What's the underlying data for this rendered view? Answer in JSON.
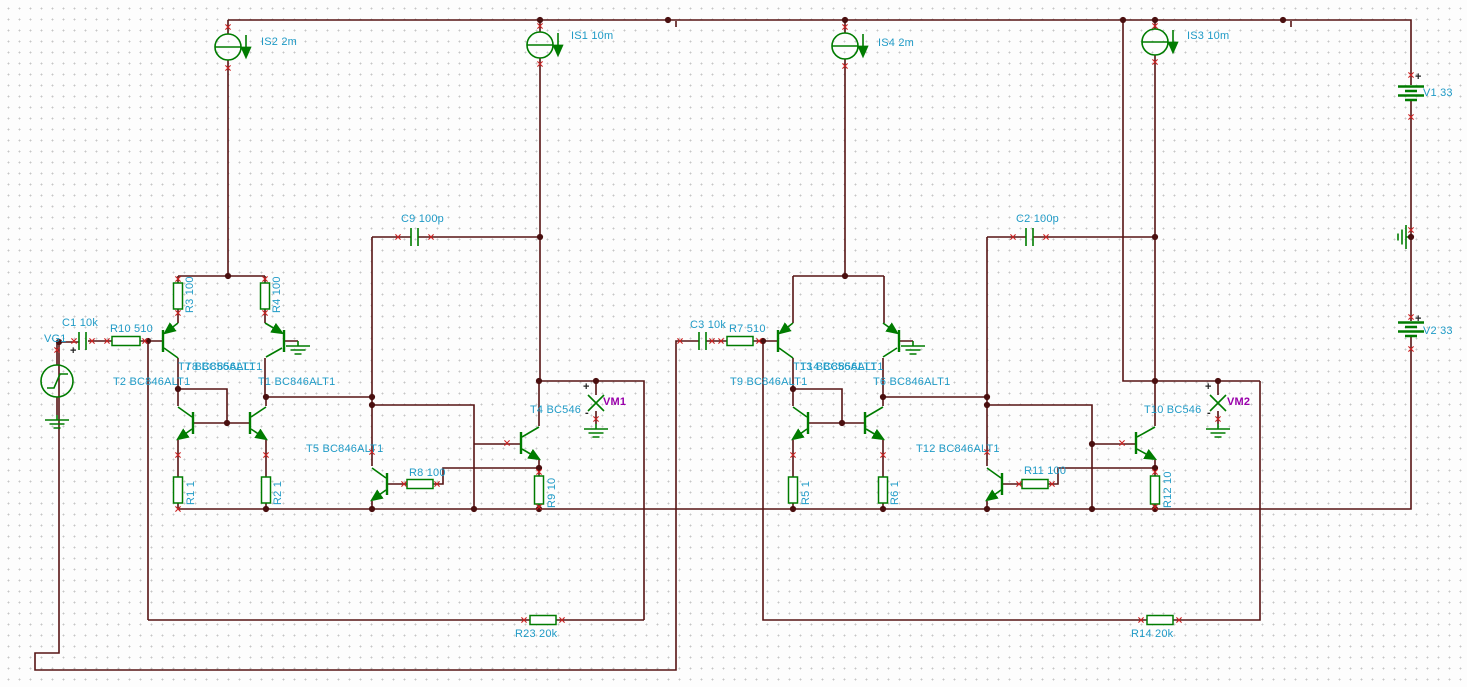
{
  "app": {
    "view": "circuit-schematic-canvas"
  },
  "colors": {
    "wire": "#571414",
    "component": "#007c00",
    "label": "#1f9ac6",
    "meter_label": "#9900aa",
    "pin_mark": "#cc2222",
    "junction": "#4a0f0f",
    "background": "#fdfdfd"
  },
  "polarity": {
    "plus": "+",
    "minus": "-"
  },
  "labels": {
    "is2": "IS2 2m",
    "is1": "IS1 10m",
    "is4": "IS4 2m",
    "is3": "IS3 10m",
    "v1": "V1 33",
    "v2": "V2 33",
    "vg1": "VG1",
    "c1": "C1 10k",
    "r10": "R10 510",
    "c9": "C9 100p",
    "r3": "R3 100",
    "r4": "R4 100",
    "t7": "T7 BC856ALT1",
    "t8": "T8 BC856ALT1",
    "t2": "T2 BC846ALT1",
    "t1": "T1 BC846ALT1",
    "r1": "R1 1",
    "r2": "R2 1",
    "t5": "T5 BC846ALT1",
    "r8": "R8 100",
    "t4": "T4 BC546",
    "vm1": "VM1",
    "r9": "R9 10",
    "r23": "R23 20k",
    "c3": "C3 10k",
    "r7": "R7 510",
    "c2": "C2 100p",
    "t13": "T13 BC856ALT1",
    "t14": "T14 BC856ALT1",
    "t9": "T9 BC846ALT1",
    "t6": "T6 BC846ALT1",
    "r5": "R5 1",
    "r6": "R6 1",
    "t12": "T12 BC846ALT1",
    "r11": "R11 100",
    "t10": "T10 BC546",
    "vm2": "VM2",
    "r12": "R12 10",
    "r14": "R14 20k"
  }
}
